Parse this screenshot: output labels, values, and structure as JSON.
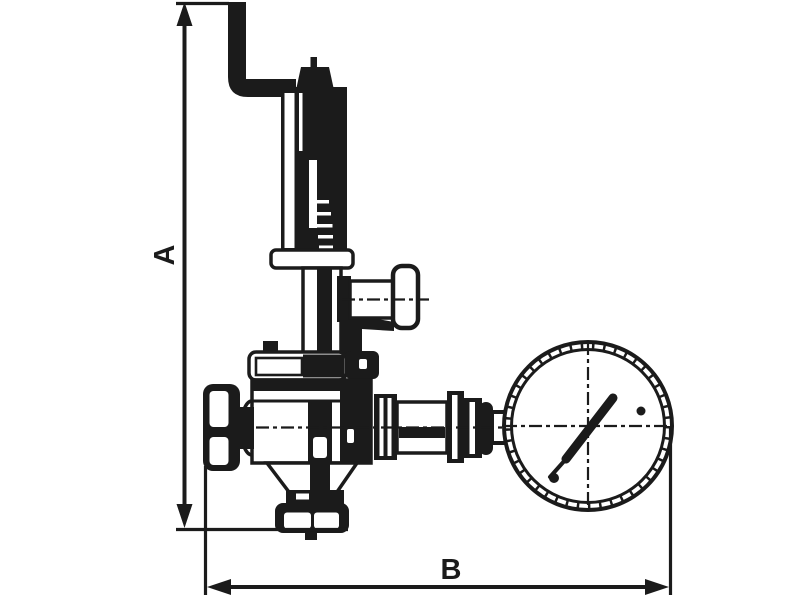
{
  "page": {
    "background": "#ffffff"
  },
  "diagram": {
    "kind": "technical line drawing",
    "subject": "pressure reducing valve with side handwheel, inlet knob, bottom union outlet and pressure gauge",
    "ink_color": "#1b1b1b",
    "labels": {
      "dim_vertical": "A",
      "dim_horizontal": "B"
    }
  }
}
